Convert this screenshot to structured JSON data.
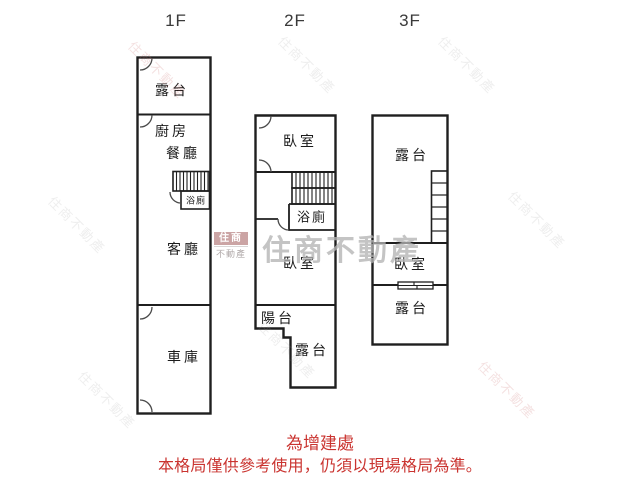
{
  "floors": [
    {
      "label": "1F",
      "rooms": {
        "terrace": "露台",
        "kitchen": "廚房",
        "dining": "餐廳",
        "bath": "浴廁",
        "living": "客廳",
        "garage": "車庫"
      }
    },
    {
      "label": "2F",
      "rooms": {
        "bedroom_top": "臥室",
        "bath": "浴廁",
        "bedroom_bottom": "臥室",
        "balcony": "陽台",
        "terrace": "露台"
      }
    },
    {
      "label": "3F",
      "rooms": {
        "terrace_top": "露台",
        "bedroom": "臥室",
        "terrace_bottom": "露台"
      }
    }
  ],
  "watermark": {
    "logo_title": "住商",
    "logo_subtitle": "不動產",
    "brand_text": "住商不動產",
    "diagonal_text": "住商不動產"
  },
  "footnote": {
    "line1": "為增建處",
    "line2": "本格局僅供參考使用，仍須以現場格局為準。",
    "color": "#ca3430"
  },
  "colors": {
    "wall": "#1f1f1f",
    "door": "#4a4a4a"
  }
}
